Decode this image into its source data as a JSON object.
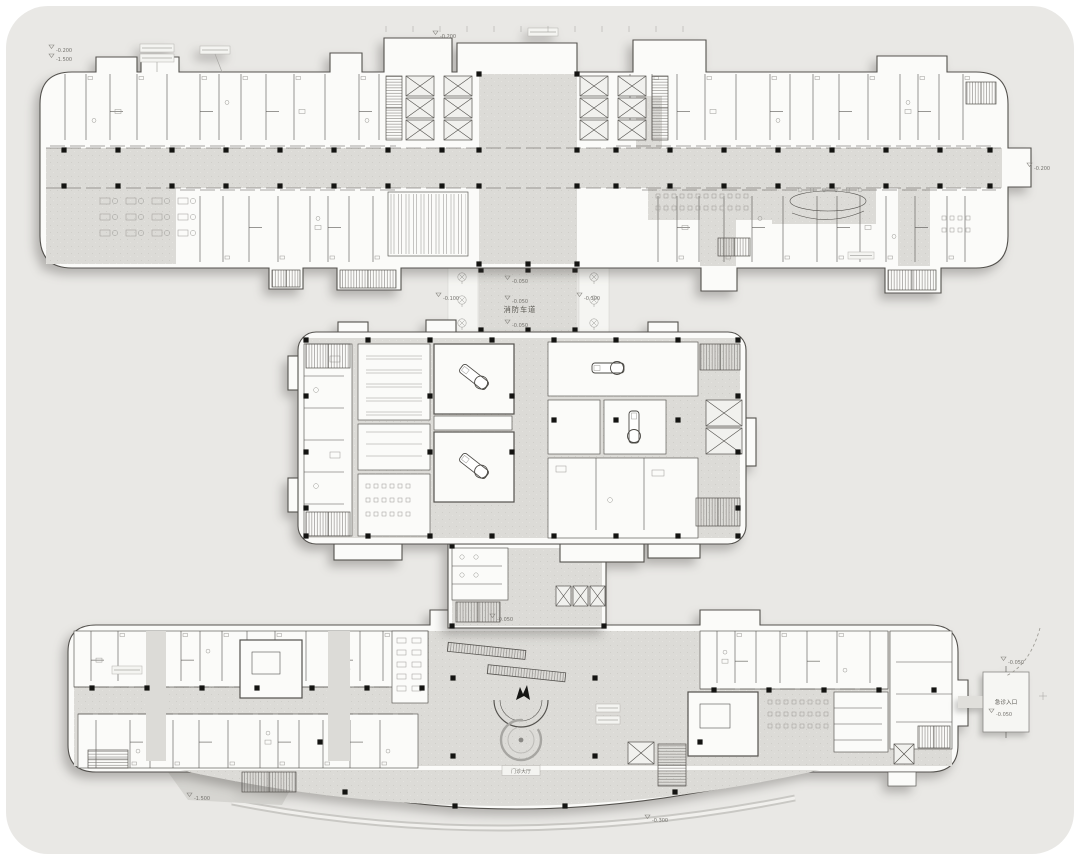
{
  "plan": {
    "fire_lane_label": "消防车道",
    "emergency_entrance_label": "急诊入口",
    "lobby_label": "门诊大厅",
    "elevation_markers": [
      "-0.200",
      "-1.500",
      "-0.200",
      "-0.200",
      "-0.050",
      "-0.050",
      "-0.050",
      "-0.100",
      "-0.300",
      "-0.050",
      "-0.050",
      "-1.500",
      "-0.300",
      "-0.050"
    ]
  },
  "colors": {
    "canvas_bg": "#ffffff",
    "site_bg": "#e9e8e5",
    "building_fill": "#fbfbf9",
    "floor_gray": "#dcdbd7",
    "wall": "#54524e",
    "column": "#141412",
    "text": "#6b6965"
  }
}
